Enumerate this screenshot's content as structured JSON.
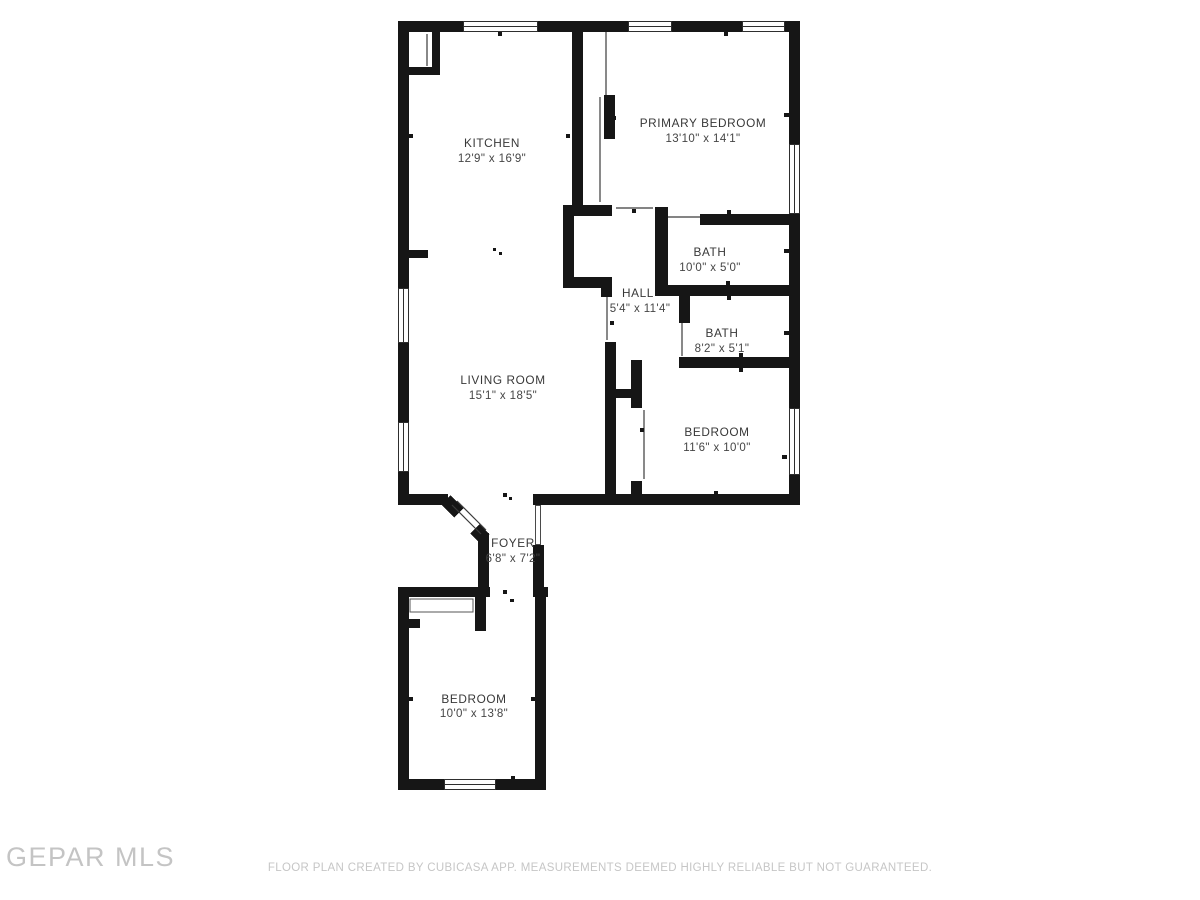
{
  "plan": {
    "rooms": [
      {
        "id": "kitchen",
        "name": "KITCHEN",
        "dims": "12'9\" x 16'9\""
      },
      {
        "id": "primary-bedroom",
        "name": "PRIMARY BEDROOM",
        "dims": "13'10\" x 14'1\""
      },
      {
        "id": "bath-upper",
        "name": "BATH",
        "dims": "10'0\" x 5'0\""
      },
      {
        "id": "hall",
        "name": "HALL",
        "dims": "5'4\" x 11'4\""
      },
      {
        "id": "bath-lower",
        "name": "BATH",
        "dims": "8'2\" x 5'1\""
      },
      {
        "id": "bedroom-right",
        "name": "BEDROOM",
        "dims": "11'6\" x 10'0\""
      },
      {
        "id": "living-room",
        "name": "LIVING ROOM",
        "dims": "15'1\" x 18'5\""
      },
      {
        "id": "foyer",
        "name": "FOYER",
        "dims": "6'8\" x 7'2\""
      },
      {
        "id": "bedroom-bottom",
        "name": "BEDROOM",
        "dims": "10'0\" x 13'8\""
      }
    ]
  },
  "branding": {
    "logo_text": "GEPAR MLS"
  },
  "footer": {
    "disclaimer": "FLOOR PLAN CREATED BY CUBICASA APP. MEASUREMENTS DEEMED HIGHLY RELIABLE BUT NOT GUARANTEED."
  },
  "colors": {
    "wall": "#161616",
    "label": "#383838",
    "muted": "#c6c6c6"
  }
}
